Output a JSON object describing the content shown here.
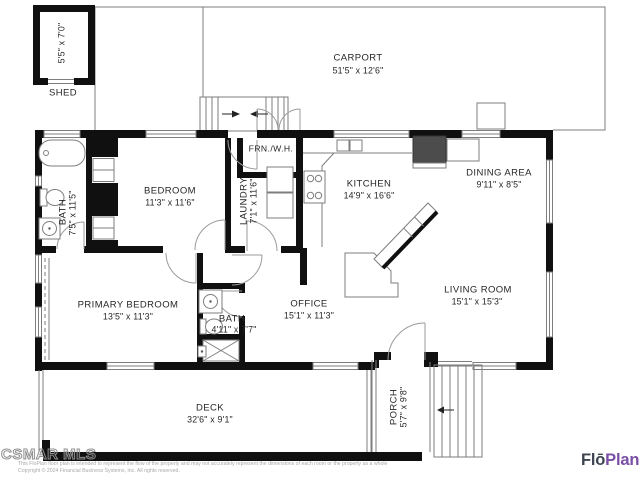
{
  "meta": {
    "width": 640,
    "height": 480,
    "type": "floor-plan"
  },
  "rooms": {
    "shed": {
      "name": "SHED",
      "dims": "5'5\" x 7'0\""
    },
    "carport": {
      "name": "CARPORT",
      "dims": "51'5\" x 12'6\""
    },
    "bedroom": {
      "name": "BEDROOM",
      "dims": "11'3\" x 11'6\""
    },
    "bath1": {
      "name": "BATH",
      "dims": "7'5\" x 11'5\""
    },
    "laundry": {
      "name": "LAUNDRY",
      "dims": "7'1\" x 11'6\""
    },
    "furnace": {
      "name": "FRN./W.H."
    },
    "kitchen": {
      "name": "KITCHEN",
      "dims": "14'9\" x 16'6\""
    },
    "dining": {
      "name": "DINING AREA",
      "dims": "9'11\" x 8'5\""
    },
    "living": {
      "name": "LIVING ROOM",
      "dims": "15'1\" x 15'3\""
    },
    "primary": {
      "name": "PRIMARY BEDROOM",
      "dims": "13'5\" x 11'3\""
    },
    "bath2": {
      "name": "BATH",
      "dims": "4'11\" x 7'7\""
    },
    "office": {
      "name": "OFFICE",
      "dims": "15'1\" x 11'3\""
    },
    "deck": {
      "name": "DECK",
      "dims": "32'6\" x 9'1\""
    },
    "porch": {
      "name": "PORCH",
      "dims": "5'7\" x 9'8\""
    }
  },
  "branding": {
    "watermark": "CSMAR MLS",
    "logo_part1": "Flō",
    "logo_part2": "Plan",
    "logo_part1_color": "#3e4550",
    "logo_part2_color": "#7a4fa6"
  },
  "disclaimer": {
    "line1": "This FloPlan floor plan is intended to represent the flow of the property and may not accurately represent the dimensions of each room or the property as a whole",
    "line2": "Copyright © 2024 Financial Business Systems, Inc. All rights reserved."
  }
}
